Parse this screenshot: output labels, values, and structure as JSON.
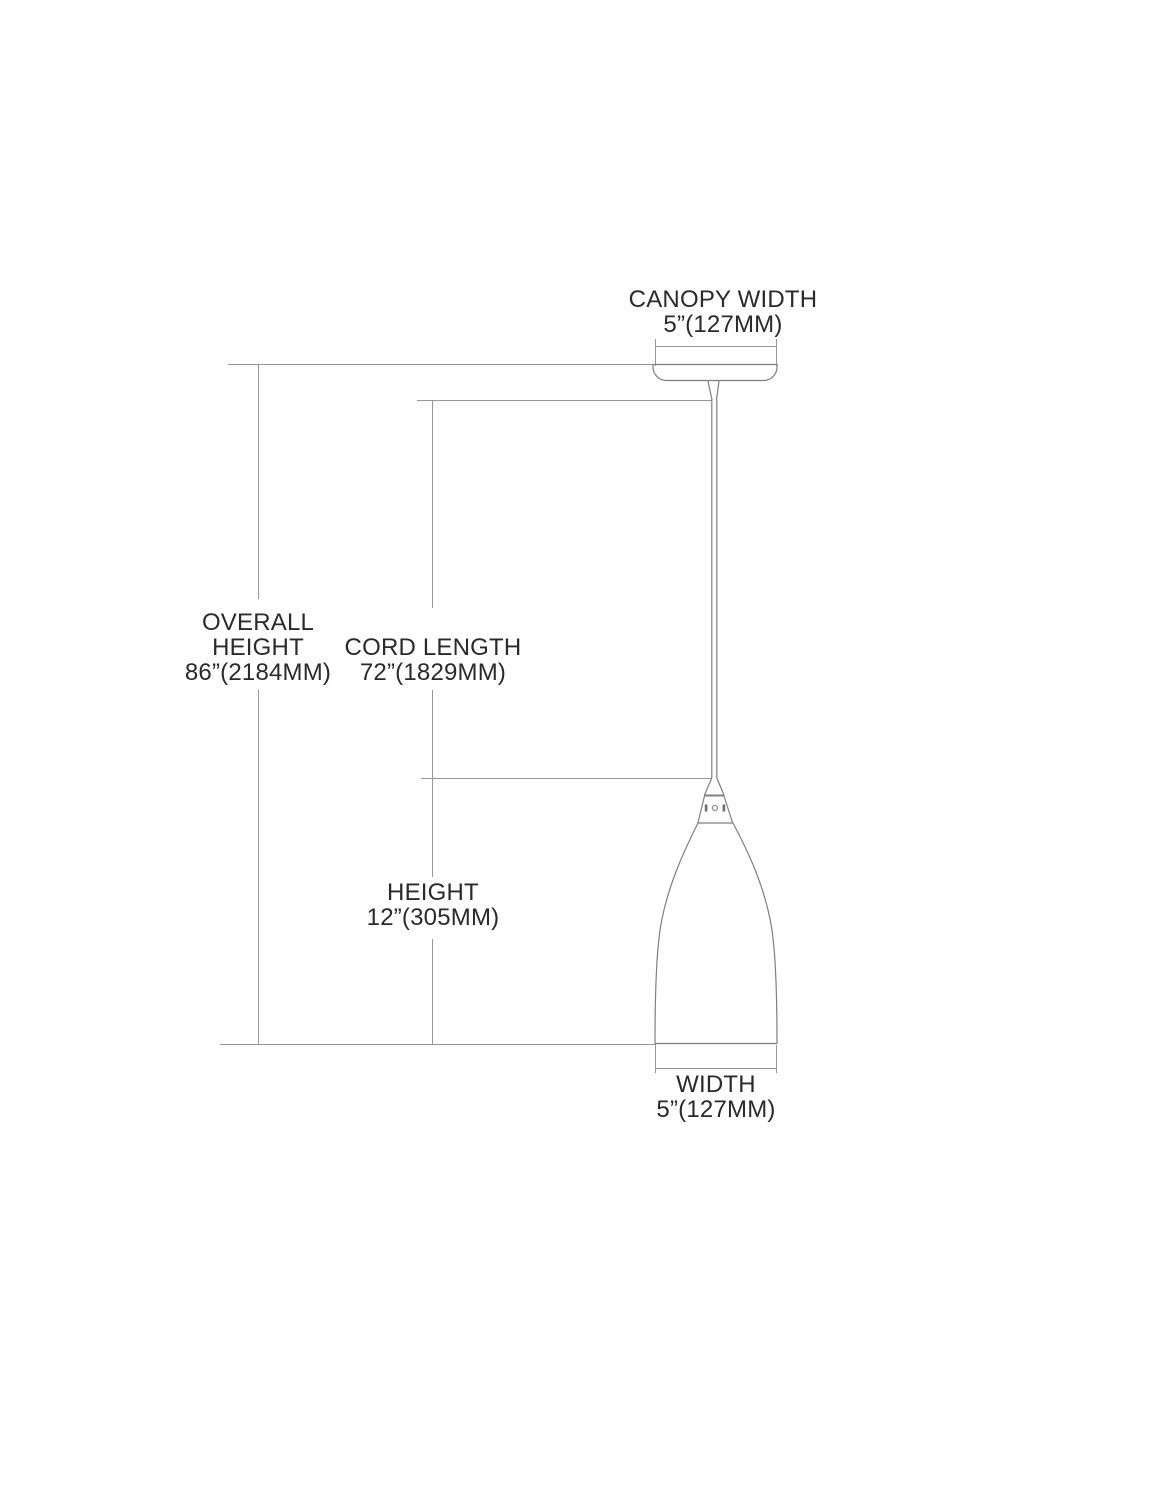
{
  "labels": {
    "canopy_width": {
      "title": "CANOPY WIDTH",
      "value": "5”(127MM)"
    },
    "overall_height": {
      "title_line1": "OVERALL",
      "title_line2": "HEIGHT",
      "value": "86”(2184MM)"
    },
    "cord_length": {
      "title": "CORD LENGTH",
      "value": "72”(1829MM)"
    },
    "height": {
      "title": "HEIGHT",
      "value": "12”(305MM)"
    },
    "width": {
      "title": "WIDTH",
      "value": "5”(127MM)"
    }
  },
  "colors": {
    "background": "#ffffff",
    "dimension_line": "#979797",
    "object_line": "#7f7f7f",
    "text": "#2a2a2a"
  }
}
